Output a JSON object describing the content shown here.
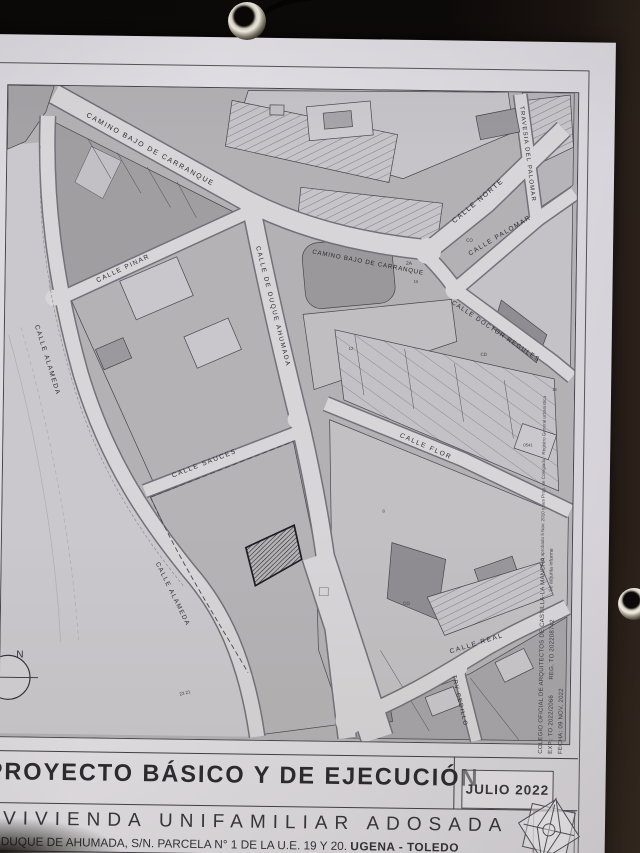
{
  "scene": {
    "background": "#0d0a09",
    "paper_color": "#dedce1",
    "accent_ink": "#2c2c32"
  },
  "title_block": {
    "project_title": "PROYECTO BÁSICO Y DE EJECUCIÓN",
    "project_subtitle": "VIVIENDA UNIFAMILIAR ADOSADA",
    "address": "C/ DUQUE DE AHUMADA, S/N. PARCELA N° 1 DE LA U.E. 19 Y 20.",
    "location": "UGENA  -  TOLEDO",
    "date_box": "JULIO 2022"
  },
  "visado_stamp": {
    "line1": "COLEGIO OFICIAL DE ARQUITECTOS DE CASTILLA-LA MANCHA",
    "line2": "EXP.: TO 2022/2066        REG. TO 202208742",
    "line3": "FECHA: 09 NOV. 2022"
  },
  "map": {
    "north_label": "N",
    "margin_note_1": "PAU aprobado 5 Nov. 2010 y sus Prog. de Colegiado · Registro General urbanística",
    "margin_note_2": "Se adjunta informe",
    "street_labels": [
      {
        "text": "CAMINO BAJO DE CARRANQUE"
      },
      {
        "text": "CALLE NORTE"
      },
      {
        "text": "TRAVESIA DEL PALOMAR"
      },
      {
        "text": "CAMINO BAJO DE CARRANQUE"
      },
      {
        "text": "CALLE PALOMAR"
      },
      {
        "text": "CALLE DOCTOR REGULES"
      },
      {
        "text": "CALLE FLOR"
      },
      {
        "text": "CALLE PINAR"
      },
      {
        "text": "CALLE ALAMEDA"
      },
      {
        "text": "CALLE DE DUQUE AHUMADA"
      },
      {
        "text": "CALLE SAUCES"
      },
      {
        "text": "CALLE ALAMEDA"
      },
      {
        "text": "CALLE REAL"
      },
      {
        "text": "TRV CEDILLO"
      }
    ],
    "parcel_labels": [
      {
        "text": "2A"
      },
      {
        "text": "10"
      },
      {
        "text": "12"
      },
      {
        "text": "CO"
      },
      {
        "text": "CD"
      },
      {
        "text": "0541"
      },
      {
        "text": "16"
      },
      {
        "text": "8"
      },
      {
        "text": "23  21"
      },
      {
        "text": "CO"
      }
    ]
  }
}
